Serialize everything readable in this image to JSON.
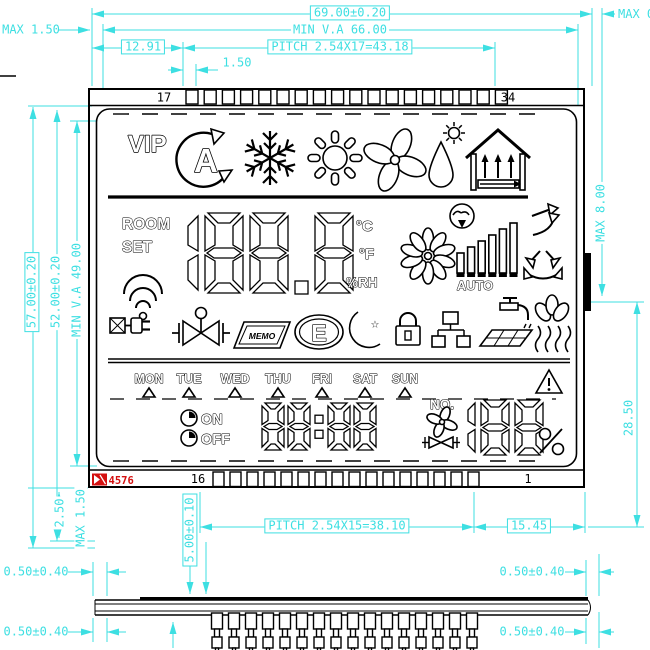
{
  "colors": {
    "dimension": "#3ddfe2",
    "line": "#000000",
    "logo_red": "#d41111"
  },
  "dims": {
    "overall_width": "69.00±0.20",
    "min_va_width": "MIN V.A 66.00",
    "pitch_top": "PITCH 2.54X17=43.18",
    "left_offset": "12.91",
    "pin_gap": "1.50",
    "max_left": "MAX 1.50",
    "max_right": "MAX 0.",
    "overall_height": "57.00±0.20",
    "inner_height": "52.00±0.20",
    "min_va_height": "MIN V.A 49.00",
    "max_bump": "MAX 8.00",
    "pin_zone_height": "28.50",
    "pitch_bottom": "PITCH 2.54X15=38.10",
    "right_offset": "15.45",
    "thickness": "5.00±0.10",
    "tail": "2.50",
    "max_tail": "MAX 1.50",
    "pin_off_left_top": "0.50±0.40",
    "pin_off_left_bottom": "0.50±0.40",
    "pin_off_right_top": "0.50±0.40",
    "pin_off_right_bottom": "0.50±0.40"
  },
  "pins": {
    "top_first": "17",
    "top_last": "34",
    "bottom_left": "16",
    "bottom_right": "1",
    "logo_code": "4576"
  },
  "lcd": {
    "vip": "VIP",
    "room": "ROOM",
    "set": "SET",
    "main_value": "188.8",
    "unit_c": "°C",
    "unit_f": "°F",
    "unit_rh": "%RH",
    "auto": "AUTO",
    "memo": "MEMO",
    "energy": "E",
    "days": [
      "MON",
      "TUE",
      "WED",
      "THU",
      "FRI",
      "SAT",
      "SUN"
    ],
    "on": "ON",
    "off": "OFF",
    "time_value": "88:88",
    "no": "NO.",
    "fan_percent": "188",
    "icons": {
      "mode_row": [
        "auto-mode-icon",
        "snowflake-icon",
        "sun-icon",
        "fan-icon",
        "humidity-drop-icon",
        "house-ventilation-icon"
      ],
      "mid_right": [
        "comfort-icon",
        "flower-fan-icon",
        "fan-speed-bars",
        "airflow-up-icon",
        "airflow-swing-icon"
      ],
      "status_row": [
        "wifi-icon",
        "power-plug-icon",
        "valve-icon",
        "memo-filter-icon",
        "energy-class-icon",
        "night-mode-icon",
        "lock-icon",
        "network-icon",
        "hot-water-floor-icon",
        "floor-heating-icon"
      ],
      "bottom_row": [
        "timer-on-clock-icon",
        "timer-off-clock-icon",
        "warning-icon",
        "small-fan-icon",
        "small-valve-icon"
      ]
    }
  }
}
